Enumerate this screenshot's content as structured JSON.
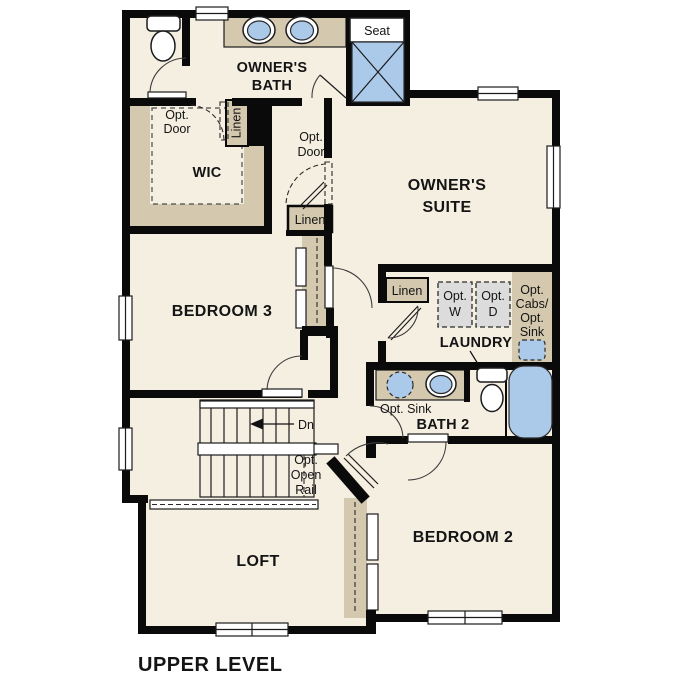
{
  "title": "UPPER LEVEL",
  "colors": {
    "wall": "#0a0a0a",
    "floor": "#f5efe2",
    "cabinet_tan": "#d4c8ae",
    "fixture_blue": "#abc9e9",
    "appliance_gray": "#dcdcdc",
    "background": "#ffffff"
  },
  "rooms": {
    "owners_bath": [
      "OWNER'S",
      "BATH"
    ],
    "wic": "WIC",
    "owners_suite": [
      "OWNER'S",
      "SUITE"
    ],
    "bedroom3": "BEDROOM 3",
    "laundry": "LAUNDRY",
    "bath2": "BATH 2",
    "bedroom2": "BEDROOM 2",
    "loft": "LOFT"
  },
  "labels": {
    "seat": "Seat",
    "opt_door": [
      "Opt.",
      "Door"
    ],
    "linen": "Linen",
    "opt_w": [
      "Opt.",
      "W"
    ],
    "opt_d": [
      "Opt.",
      "D"
    ],
    "opt_cabs_sink": [
      "Opt.",
      "Cabs/",
      "Opt.",
      "Sink"
    ],
    "opt_sink": "Opt. Sink",
    "dn": "Dn",
    "opt_open_rail": [
      "Opt.",
      "Open",
      "Rail"
    ]
  }
}
